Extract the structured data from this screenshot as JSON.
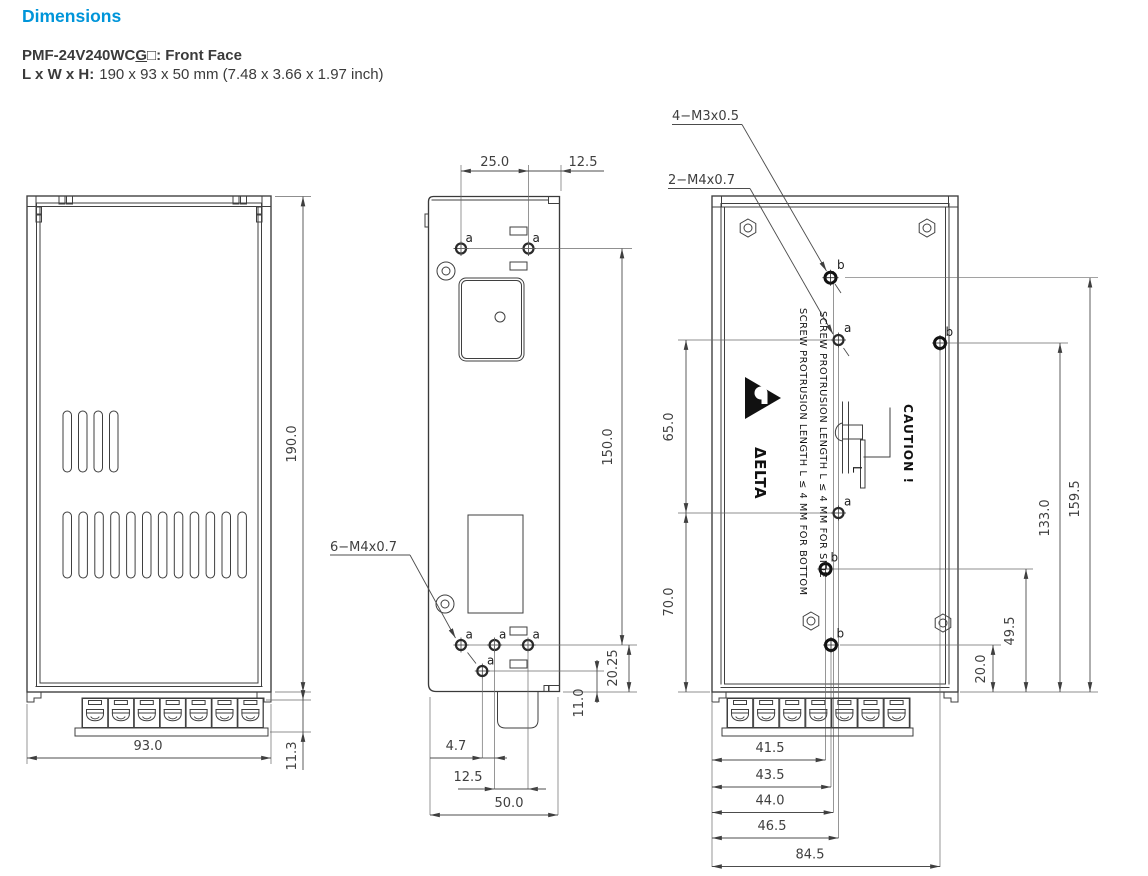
{
  "header": {
    "title": "Dimensions",
    "model_prefix": "PMF-24V240WC",
    "model_underlined": "G",
    "model_box": "□",
    "model_suffix": ": Front Face",
    "size_label": "L x W x H:",
    "size_value": "190 x 93 x 50 mm (7.48 x 3.66 x 1.97 inch)",
    "accent_color": "#0095d9"
  },
  "front_view": {
    "dim_length": "190.0",
    "dim_width": "93.0",
    "dim_terminal_height": "11.3"
  },
  "side_view": {
    "thread_label": "6−M4x0.7",
    "hole_label": "a",
    "dim_hole_pitch": "25.0",
    "dim_hole_edge": "12.5",
    "dim_hole_span": "150.0",
    "dim_bottom_1": "20.25",
    "dim_bottom_2": "11.0",
    "dim_base_1": "4.7",
    "dim_base_2": "12.5",
    "dim_base_3": "50.0"
  },
  "back_view": {
    "thread_label_m3": "4−M3x0.5",
    "thread_label_m4": "2−M4x0.7",
    "hole_label_a": "a",
    "hole_label_b": "b",
    "dim_upper": "65.0",
    "dim_lower": "70.0",
    "dim_right_1": "159.5",
    "dim_right_2": "133.0",
    "dim_right_3": "49.5",
    "dim_right_4": "20.0",
    "dim_base_1": "41.5",
    "dim_base_2": "43.5",
    "dim_base_3": "44.0",
    "dim_base_4": "46.5",
    "dim_base_5": "84.5",
    "caution_text": "CAUTION !",
    "screw_length_label": "L",
    "note_side": "SCREW PROTRUSION LENGTH  L ≤ 4 MM FOR SIDE",
    "note_bottom": "SCREW PROTRUSION LENGTH  L ≤ 4 MM FOR BOTTOM",
    "brand": "ΔELTA"
  }
}
